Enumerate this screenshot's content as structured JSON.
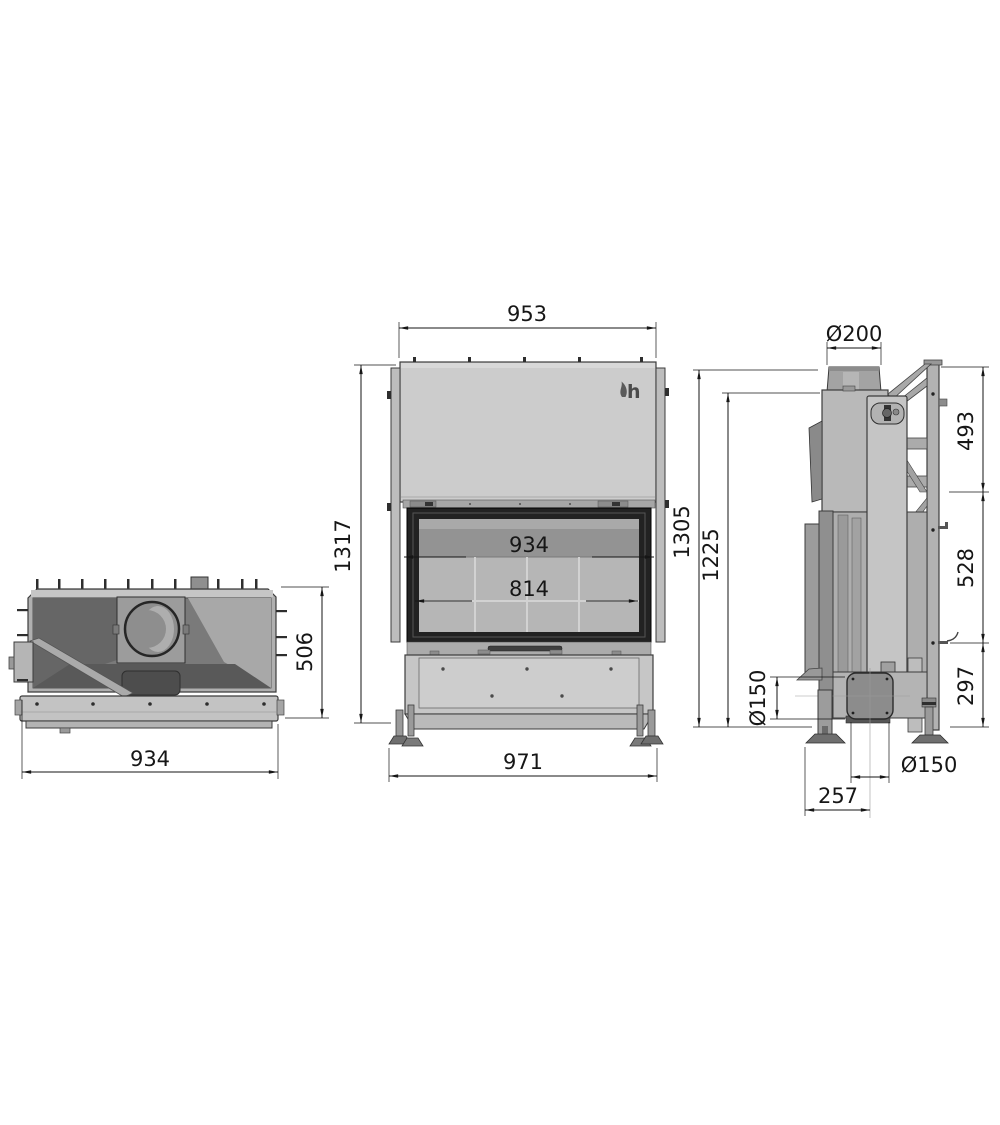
{
  "colors": {
    "background": "#ffffff",
    "line": "#161616",
    "metal_light": "#cccccc",
    "metal_mid": "#a8a8a8",
    "metal_dark": "#6e6e6e",
    "door_frame": "#222222"
  },
  "top_view": {
    "width": "934",
    "depth": "506"
  },
  "front_view": {
    "top_width": "953",
    "overall_height": "1317",
    "door_width": "934",
    "glass_width": "814",
    "base_width": "971",
    "logo": "h"
  },
  "side_view": {
    "flue_diameter": "Ø200",
    "top_section_height": "493",
    "overall_height": "1305",
    "body_height": "1225",
    "mid_section_height": "528",
    "bottom_section_height": "297",
    "intake_diameter_side": "Ø150",
    "intake_diameter_bottom": "Ø150",
    "front_depth": "257"
  }
}
